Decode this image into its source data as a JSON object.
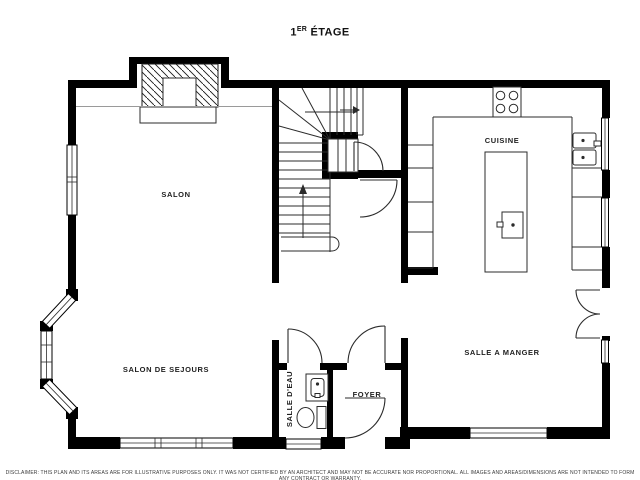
{
  "title": {
    "number": "1",
    "superscript": "ER",
    "word": " ÉTAGE"
  },
  "rooms": {
    "salon": "SALON",
    "salon_de_sejours": "SALON DE SEJOURS",
    "salle_deau": "SALLE D'EAU",
    "foyer": "FOYER",
    "cuisine": "CUISINE",
    "salle_a_manger": "SALLE A MANGER"
  },
  "disclaimer": "DISCLAIMER: THIS PLAN AND ITS AREAS ARE FOR ILLUSTRATIVE PURPOSES ONLY. IT WAS NOT CERTIFIED BY AN ARCHITECT AND MAY NOT BE ACCURATE NOR PROPORTIONAL. ALL IMAGES AND AREAS/DIMENSIONS ARE NOT INTENDED TO FORM ANY CONTRACT OR WARRANTY.",
  "colors": {
    "wall": "#000000",
    "line": "#2b2b2b",
    "background": "#ffffff",
    "text": "#1f1f1f"
  }
}
